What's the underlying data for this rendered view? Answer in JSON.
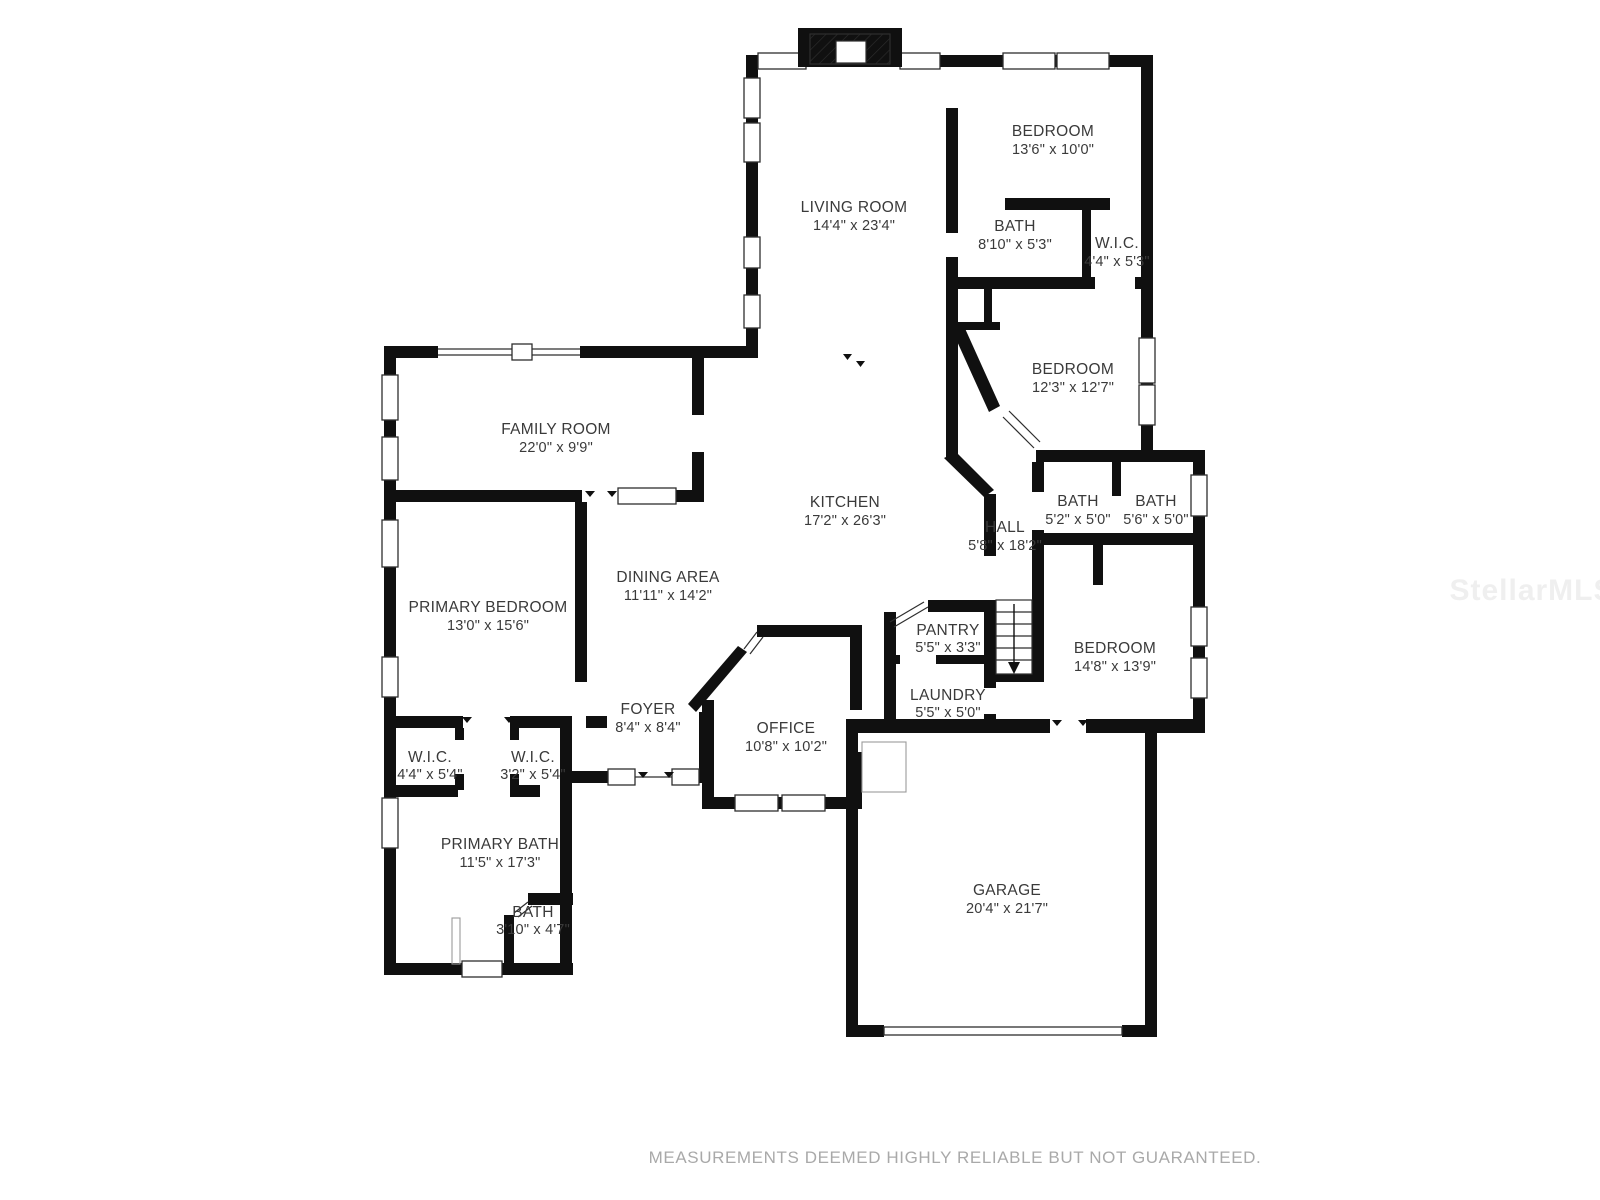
{
  "colors": {
    "wall": "#101010",
    "label": "#3a3a3a",
    "disclaimer_text": "#a9a9a9",
    "watermark_text": "#efefef"
  },
  "rooms": [
    {
      "name": "LIVING ROOM",
      "dims": "14'4\" x 23'4\""
    },
    {
      "name": "BEDROOM",
      "dims": "13'6\" x 10'0\""
    },
    {
      "name": "BATH",
      "dims": "8'10\" x 5'3\""
    },
    {
      "name": "W.I.C.",
      "dims": "4'4\" x 5'3\""
    },
    {
      "name": "BEDROOM",
      "dims": "12'3\" x 12'7\""
    },
    {
      "name": "FAMILY ROOM",
      "dims": "22'0\" x 9'9\""
    },
    {
      "name": "KITCHEN",
      "dims": "17'2\" x 26'3\""
    },
    {
      "name": "HALL",
      "dims": "5'8\" x 18'2\""
    },
    {
      "name": "BATH",
      "dims": "5'2\" x 5'0\""
    },
    {
      "name": "BATH",
      "dims": "5'6\" x 5'0\""
    },
    {
      "name": "PRIMARY BEDROOM",
      "dims": "13'0\" x 15'6\""
    },
    {
      "name": "DINING AREA",
      "dims": "11'11\" x 14'2\""
    },
    {
      "name": "PANTRY",
      "dims": "5'5\" x 3'3\""
    },
    {
      "name": "LAUNDRY",
      "dims": "5'5\" x 5'0\""
    },
    {
      "name": "BEDROOM",
      "dims": "14'8\" x 13'9\""
    },
    {
      "name": "W.I.C.",
      "dims": "4'4\" x 5'4\""
    },
    {
      "name": "W.I.C.",
      "dims": "3'2\" x 5'4\""
    },
    {
      "name": "FOYER",
      "dims": "8'4\" x 8'4\""
    },
    {
      "name": "OFFICE",
      "dims": "10'8\" x 10'2\""
    },
    {
      "name": "PRIMARY BATH",
      "dims": "11'5\" x 17'3\""
    },
    {
      "name": "BATH",
      "dims": "3'10\" x 4'7\""
    },
    {
      "name": "GARAGE",
      "dims": "20'4\" x 21'7\""
    }
  ],
  "footer": {
    "disclaimer": "MEASUREMENTS DEEMED HIGHLY RELIABLE BUT NOT GUARANTEED."
  },
  "watermark": "StellarMLS"
}
